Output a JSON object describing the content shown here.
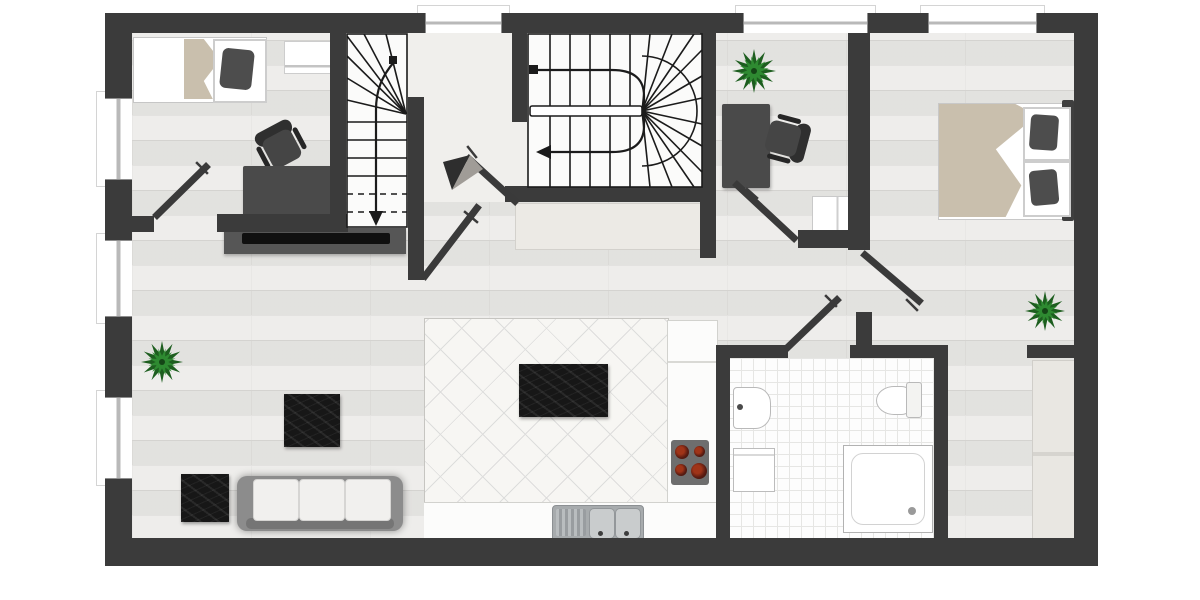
{
  "document": {
    "kind": "floor-plan-top-view",
    "storeys_shown": 1,
    "visible_text": []
  },
  "theme": {
    "wall": "#3b3b3b",
    "floor": "#e7e6e3",
    "plank": "#d8d7d4",
    "hall": "#f0efec",
    "kitchen": "#f7f6f3",
    "bath": "#fdfdfd",
    "marble": "#171717",
    "beige": "#c9bfad",
    "green1": "#1d5e1f",
    "green2": "#2e8a31",
    "sofa": "#8c8c8c",
    "cushion": "#f1f0ee",
    "darkfurn": "#4a4a4a",
    "steel": "#a7abad",
    "counter": "#fcfcfb"
  },
  "floor_plan": {
    "windows": {
      "top_wall": 3,
      "left_wall": 3
    },
    "interior_doors": 6,
    "staircases": [
      {
        "id": "straight-staircase",
        "style": "straight-with-winder-top",
        "direction_arrow": "down"
      },
      {
        "id": "main-winder-staircase",
        "style": "u-shaped-double-flight-winder",
        "direction_arrow": "down"
      }
    ],
    "rooms": [
      {
        "id": "bedroom-top-left",
        "items": [
          "single-bed",
          "dark-pillow",
          "beige-blanket",
          "wall-shelf",
          "desk",
          "desk-papers",
          "office-chair"
        ]
      },
      {
        "id": "hallway-stair-core",
        "items": [
          "straight-staircase",
          "main-winder-staircase",
          "sideboard",
          "view-direction-marker",
          "doors"
        ]
      },
      {
        "id": "office",
        "items": [
          "potted-plant",
          "desk",
          "desk-papers",
          "office-chair",
          "small-cabinet"
        ]
      },
      {
        "id": "bedroom-top-right",
        "items": [
          "double-bed",
          "two-dark-pillows",
          "beige-blanket",
          "headboard",
          "nightstand",
          "nightstand",
          "potted-plant"
        ]
      },
      {
        "id": "living-room",
        "items": [
          "potted-plant",
          "tv-sideboard",
          "tv",
          "marble-coffee-table",
          "marble-side-table",
          "sofa-three-cushions"
        ]
      },
      {
        "id": "kitchen-dining",
        "items": [
          "diagonal-tile-floor",
          "marble-dining-table",
          "four-dining-chairs",
          "l-shaped-counter",
          "cooktop-four-burners",
          "double-sink-with-drainboard"
        ]
      },
      {
        "id": "bathroom",
        "items": [
          "tiled-floor",
          "wash-basin",
          "toilet",
          "washing-machine",
          "shower-tray"
        ]
      },
      {
        "id": "closet-room",
        "items": [
          "wardrobe"
        ]
      }
    ]
  }
}
